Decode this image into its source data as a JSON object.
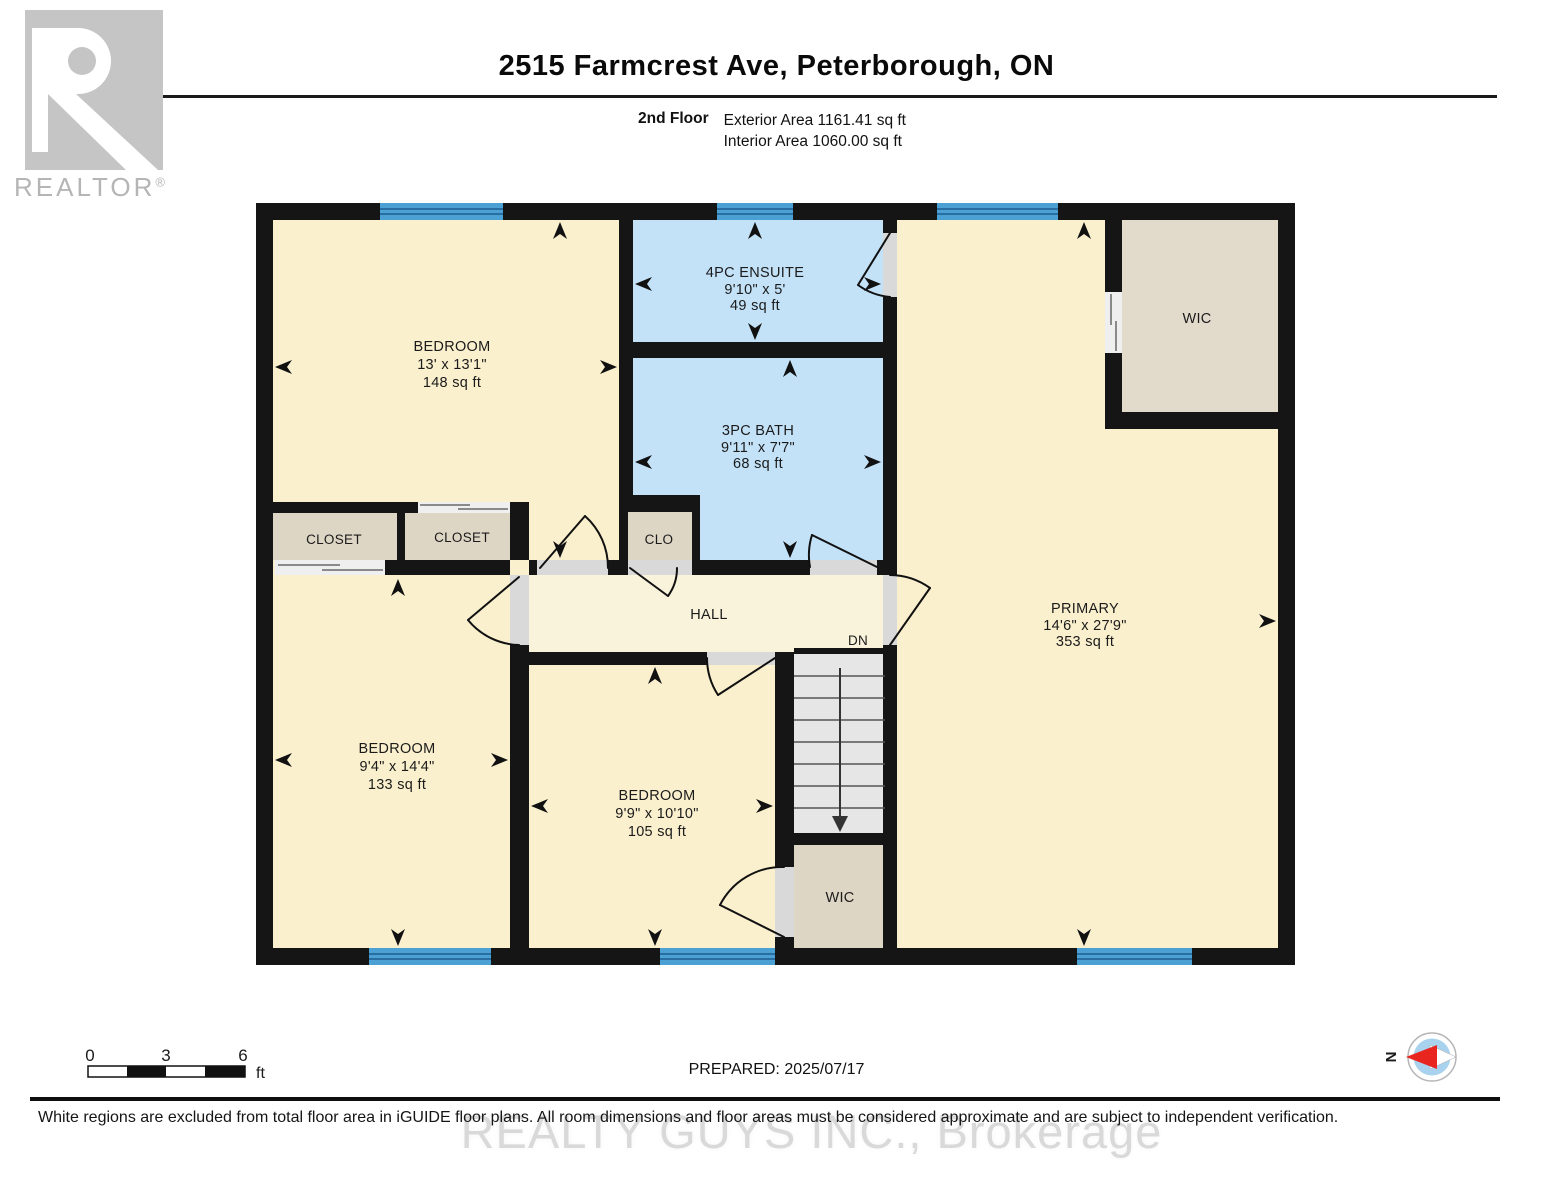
{
  "header": {
    "logo": {
      "brand": "REALTOR",
      "reg": "®"
    },
    "title": "2515 Farmcrest Ave, Peterborough, ON",
    "floor_label": "2nd Floor",
    "exterior_area": "Exterior Area 1161.41 sq ft",
    "interior_area": "Interior Area 1060.00 sq ft"
  },
  "rooms": {
    "bedroom_top_left": {
      "name": "BEDROOM",
      "dims": "13' x 13'1\"",
      "area": "148 sq ft"
    },
    "ensuite": {
      "name": "4PC ENSUITE",
      "dims": "9'10\" x 5'",
      "area": "49 sq ft"
    },
    "bath": {
      "name": "3PC BATH",
      "dims": "9'11\" x 7'7\"",
      "area": "68 sq ft"
    },
    "wic_top": {
      "name": "WIC"
    },
    "primary": {
      "name": "PRIMARY",
      "dims": "14'6\" x 27'9\"",
      "area": "353 sq ft"
    },
    "closet_left": {
      "name": "CLOSET"
    },
    "closet_mid": {
      "name": "CLOSET"
    },
    "clo": {
      "name": "CLO"
    },
    "hall": {
      "name": "HALL"
    },
    "stairs": {
      "label": "DN"
    },
    "bedroom_bottom_left": {
      "name": "BEDROOM",
      "dims": "9'4\" x 14'4\"",
      "area": "133 sq ft"
    },
    "bedroom_bottom_mid": {
      "name": "BEDROOM",
      "dims": "9'9\" x 10'10\"",
      "area": "105 sq ft"
    },
    "wic_bottom": {
      "name": "WIC"
    }
  },
  "footer": {
    "scale": {
      "tick0": "0",
      "tick1": "3",
      "tick2": "6",
      "unit": "ft"
    },
    "prepared": "PREPARED: 2025/07/17",
    "compass": {
      "north": "N"
    },
    "disclaimer": "White regions are excluded from total floor area in iGUIDE floor plans. All room dimensions and floor areas must be considered approximate and are subject to independent verification.",
    "watermark": "REALTY GUYS INC., Brokerage"
  },
  "colors": {
    "room_fill": "#faf0ce",
    "hall_fill": "#f9f3dc",
    "bath_fill": "#c3e2f8",
    "closet_fill": "#ded6c5",
    "wic_fill": "#e2dbcc",
    "stairs_fill": "#e6e6e6",
    "threshold": "#d9d9d9",
    "window_blue": "#4ba1d4",
    "window_line": "#1c5e90",
    "wall": "#151515",
    "watermark_gray": "#d9d9d9",
    "logo_gray": "#c5c5c5",
    "compass_red": "#e8251f",
    "compass_blue": "#a9d2ee"
  }
}
